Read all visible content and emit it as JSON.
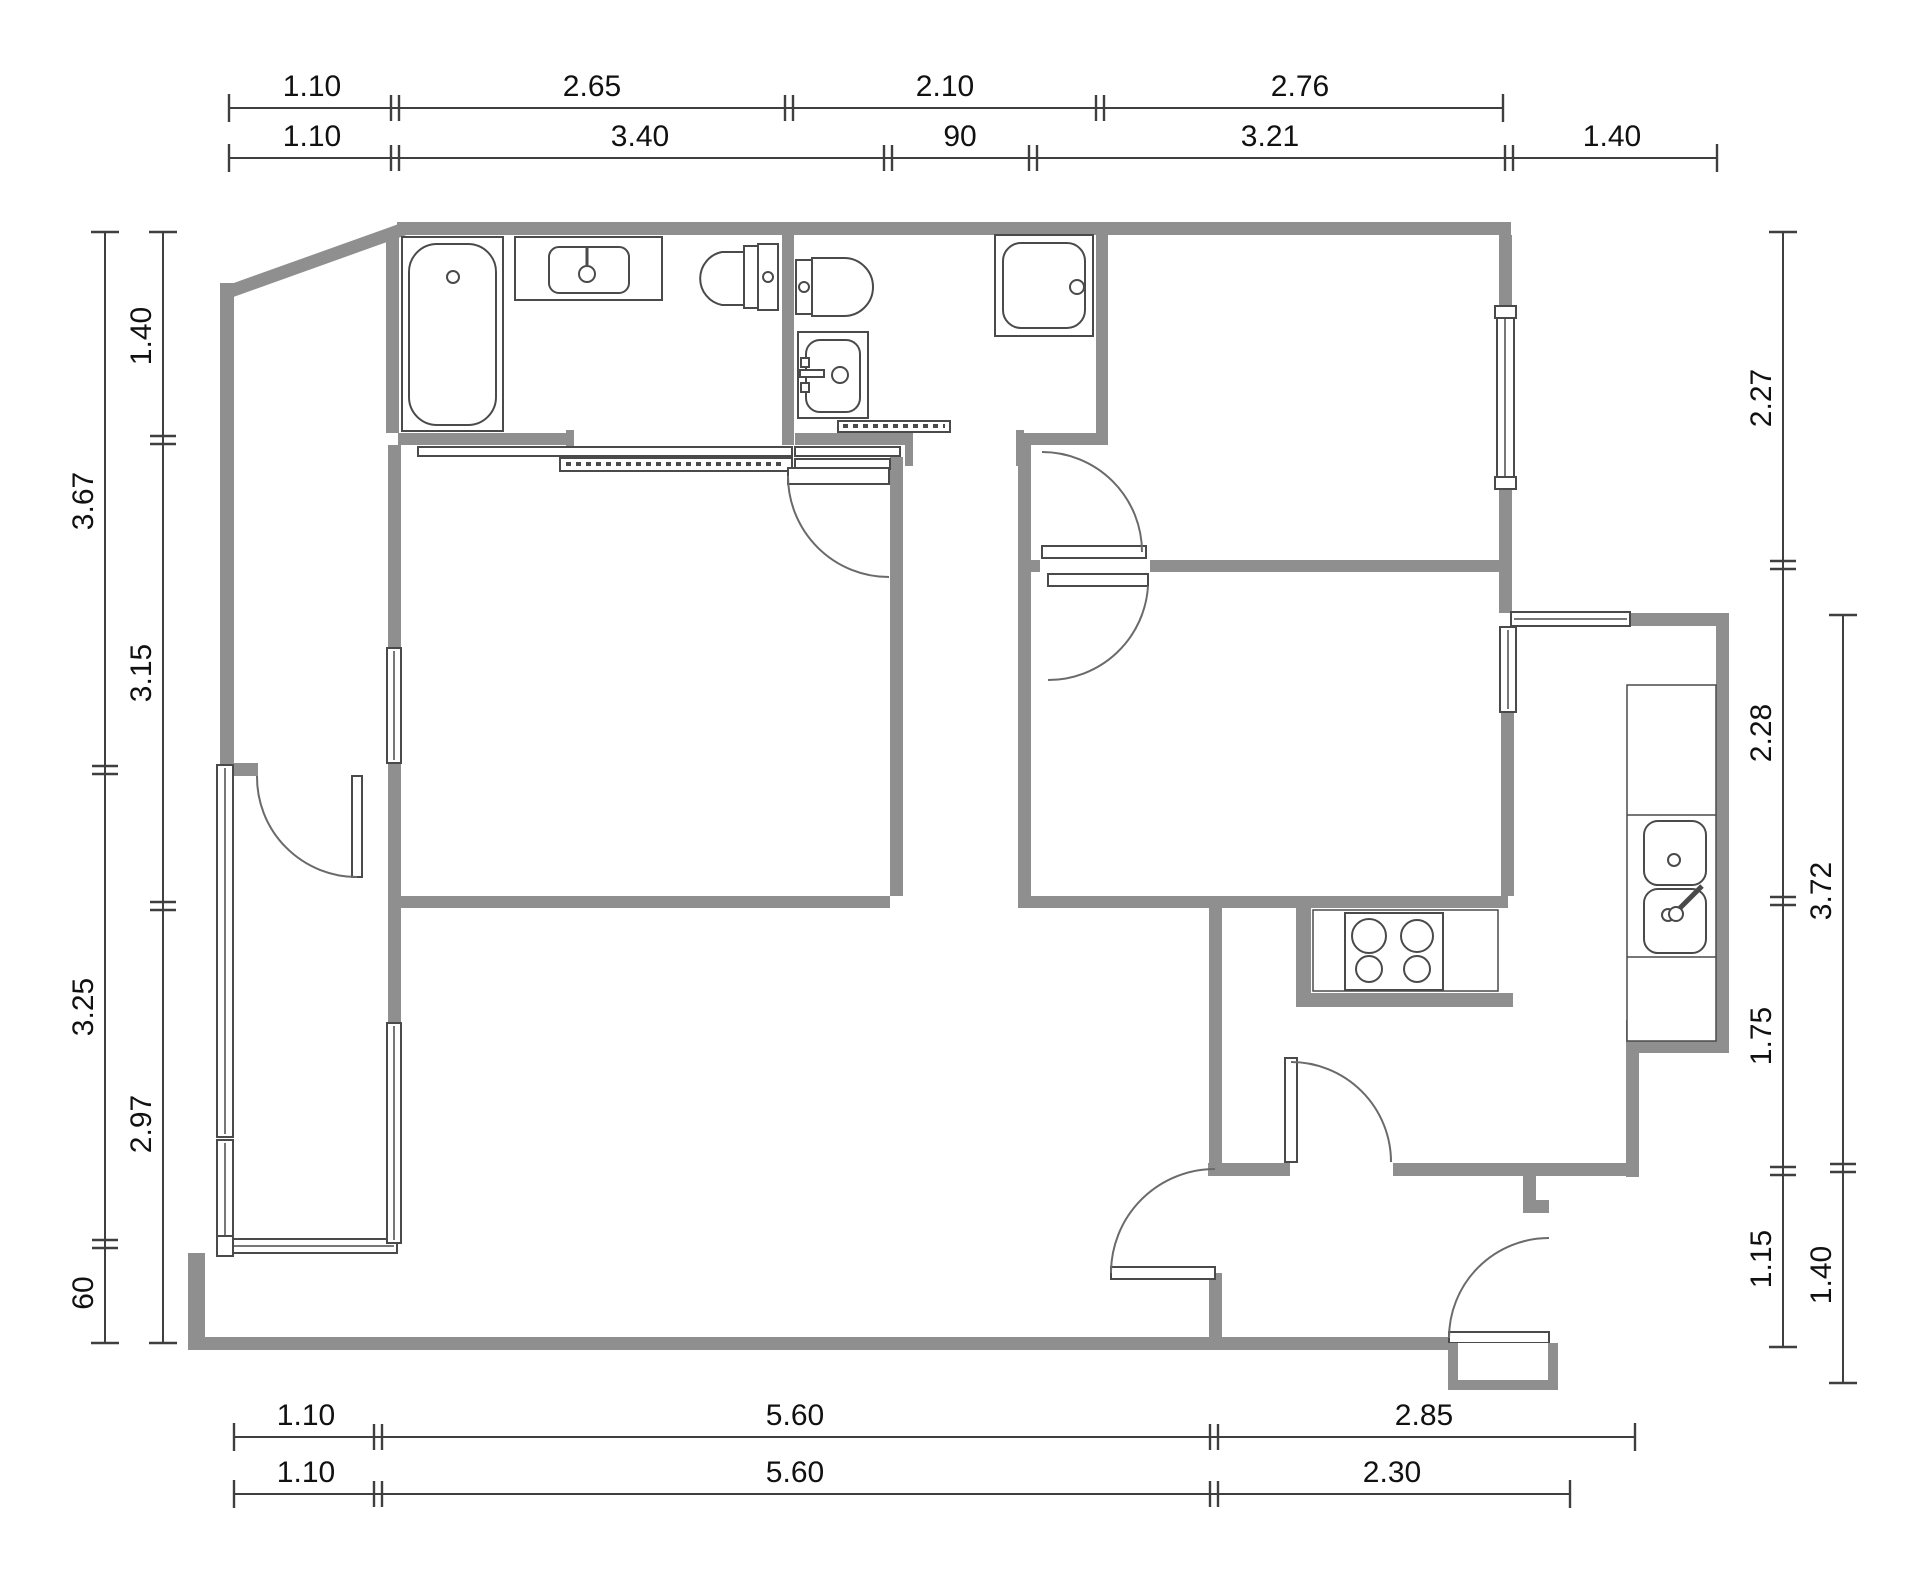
{
  "drawing": {
    "type": "architectural-floor-plan",
    "units": "meters",
    "colors": {
      "wall": "#8f8f8f",
      "line": "#4a4a4a",
      "dim_line": "#3f3f3f",
      "text": "#111111",
      "background": "#ffffff"
    }
  },
  "dimensions": {
    "top_row1": [
      "1.10",
      "2.65",
      "2.10",
      "2.76"
    ],
    "top_row2": [
      "1.10",
      "3.40",
      "90",
      "3.21",
      "1.40"
    ],
    "bottom_row1": [
      "1.10",
      "5.60",
      "2.85"
    ],
    "bottom_row2": [
      "1.10",
      "5.60",
      "2.30"
    ],
    "left_outer": [
      "3.67",
      "3.25",
      "60"
    ],
    "left_inner": [
      "1.40",
      "3.15",
      "2.97"
    ],
    "right_inner": [
      "2.27",
      "2.28",
      "1.75",
      "1.15"
    ],
    "right_outer": [
      "3.72",
      "1.40"
    ]
  },
  "fixtures": [
    "bathtub",
    "vanity-sink",
    "toilet",
    "bidet",
    "toilet",
    "washbasin",
    "shower-tray",
    "cooktop-hob",
    "kitchen-double-sink",
    "entry-step"
  ]
}
